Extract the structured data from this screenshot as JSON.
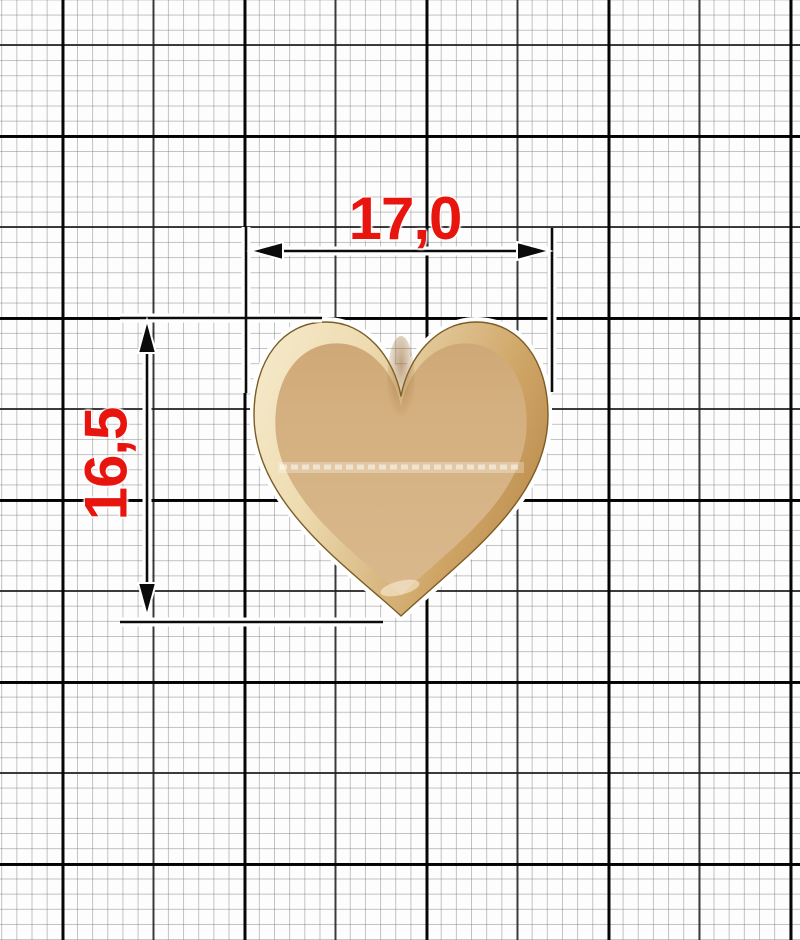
{
  "drawing": {
    "title": "heart accessory dimension drawing",
    "figure_icon": "heart-charm-icon",
    "background_icon": "millimeter-graph-paper",
    "dimensions": {
      "width": {
        "label": "17,0",
        "value_mm": 17.0,
        "orientation": "horizontal"
      },
      "height": {
        "label": "16,5",
        "value_mm": 16.5,
        "orientation": "vertical"
      }
    },
    "colors": {
      "dimension_text": "#e8140e",
      "line_ink": "#0b0b0b",
      "grid_fine": "#c6c6c6",
      "grid_major": "#000000",
      "paper": "#fdfdfd",
      "heart_rim_light": "#f5e9c9",
      "heart_rim_dark": "#bd8f50",
      "heart_fill": "#d6b384",
      "heart_outline": "#7c5c26"
    }
  }
}
